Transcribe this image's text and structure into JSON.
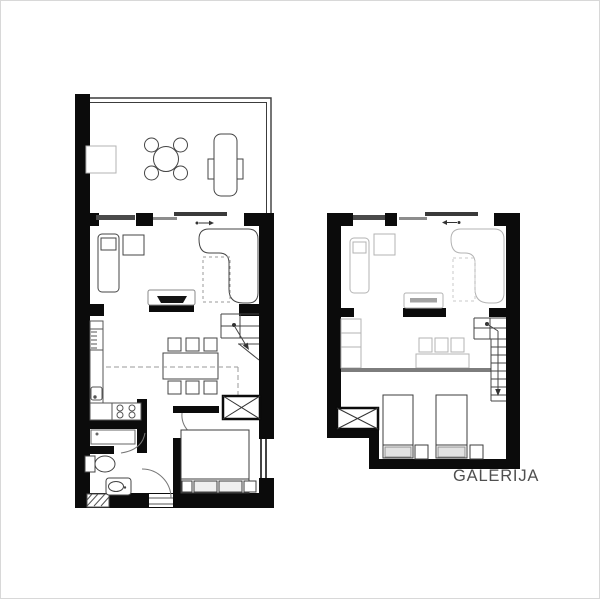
{
  "labels": {
    "gallery": "GALERIJA"
  },
  "plans": [
    {
      "id": "main-floor-plan",
      "label": ""
    },
    {
      "id": "gallery-plan",
      "label": "GALERIJA"
    }
  ],
  "colors": {
    "wall": "#0b0b0b",
    "furniture_dark": "#444444",
    "furniture_kitchen": "#555555",
    "furniture_faded": "#b3b3b3",
    "railing_edge": "#7d7d7d",
    "window_bar": "#4a4a4a",
    "sliding_door_dark": "#3a3a3a",
    "sliding_door_light": "#8d8d8d",
    "dashed_line": "#9a9a9a",
    "label_text": "#4f4f4f",
    "background": "#ffffff"
  }
}
